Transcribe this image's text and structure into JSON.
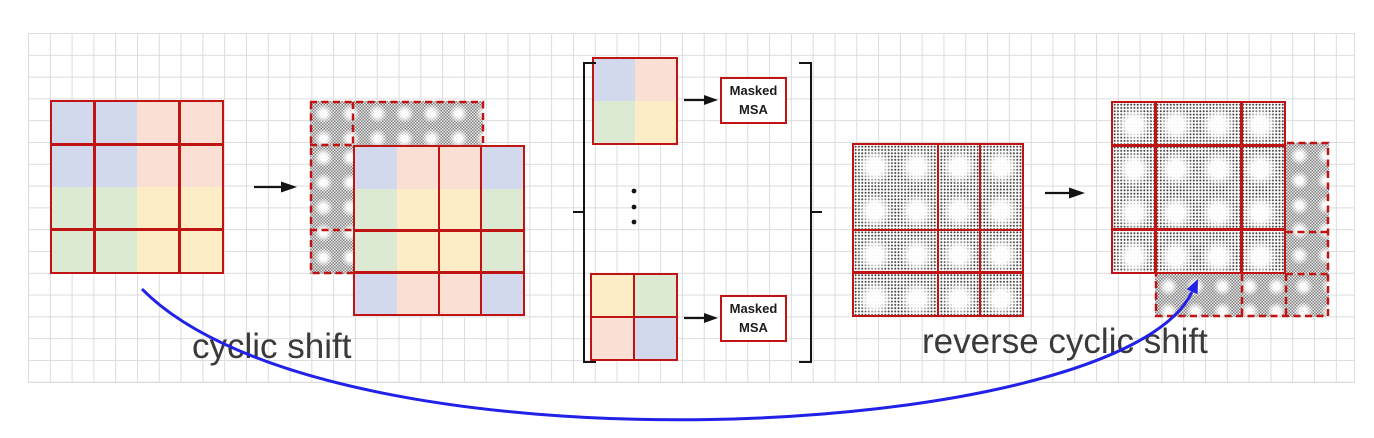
{
  "figure": {
    "caption_left": "cyclic shift",
    "caption_right": "reverse cyclic shift",
    "msa_box_top": {
      "line1": "Masked",
      "line2": "MSA"
    },
    "msa_box_bottom": {
      "line1": "Masked",
      "line2": "MSA"
    },
    "palette": {
      "blue": "#d3d9ec",
      "peach": "#fadfd4",
      "green": "#ddead3",
      "yellow": "#fdedc6",
      "red": "#c01414",
      "ink": "#3a3a3a",
      "arrow_blue": "#2121e8",
      "gridline": "#dcdcdc"
    },
    "maps": {
      "feature_map": {
        "cells": [
          [
            "blue",
            "blue",
            "peach",
            "peach"
          ],
          [
            "blue",
            "blue",
            "peach",
            "peach"
          ],
          [
            "green",
            "green",
            "yellow",
            "yellow"
          ],
          [
            "green",
            "green",
            "yellow",
            "yellow"
          ]
        ]
      },
      "cyclic_shifted_map": {
        "cells": [
          [
            "blue",
            "peach",
            "peach",
            "blue"
          ],
          [
            "green",
            "yellow",
            "yellow",
            "green"
          ],
          [
            "green",
            "yellow",
            "yellow",
            "green"
          ],
          [
            "blue",
            "peach",
            "peach",
            "blue"
          ]
        ]
      },
      "window_first": {
        "cells": [
          [
            "blue",
            "peach"
          ],
          [
            "green",
            "yellow"
          ]
        ]
      },
      "window_last": {
        "cells": [
          [
            "yellow",
            "green"
          ],
          [
            "peach",
            "blue"
          ]
        ]
      }
    }
  }
}
